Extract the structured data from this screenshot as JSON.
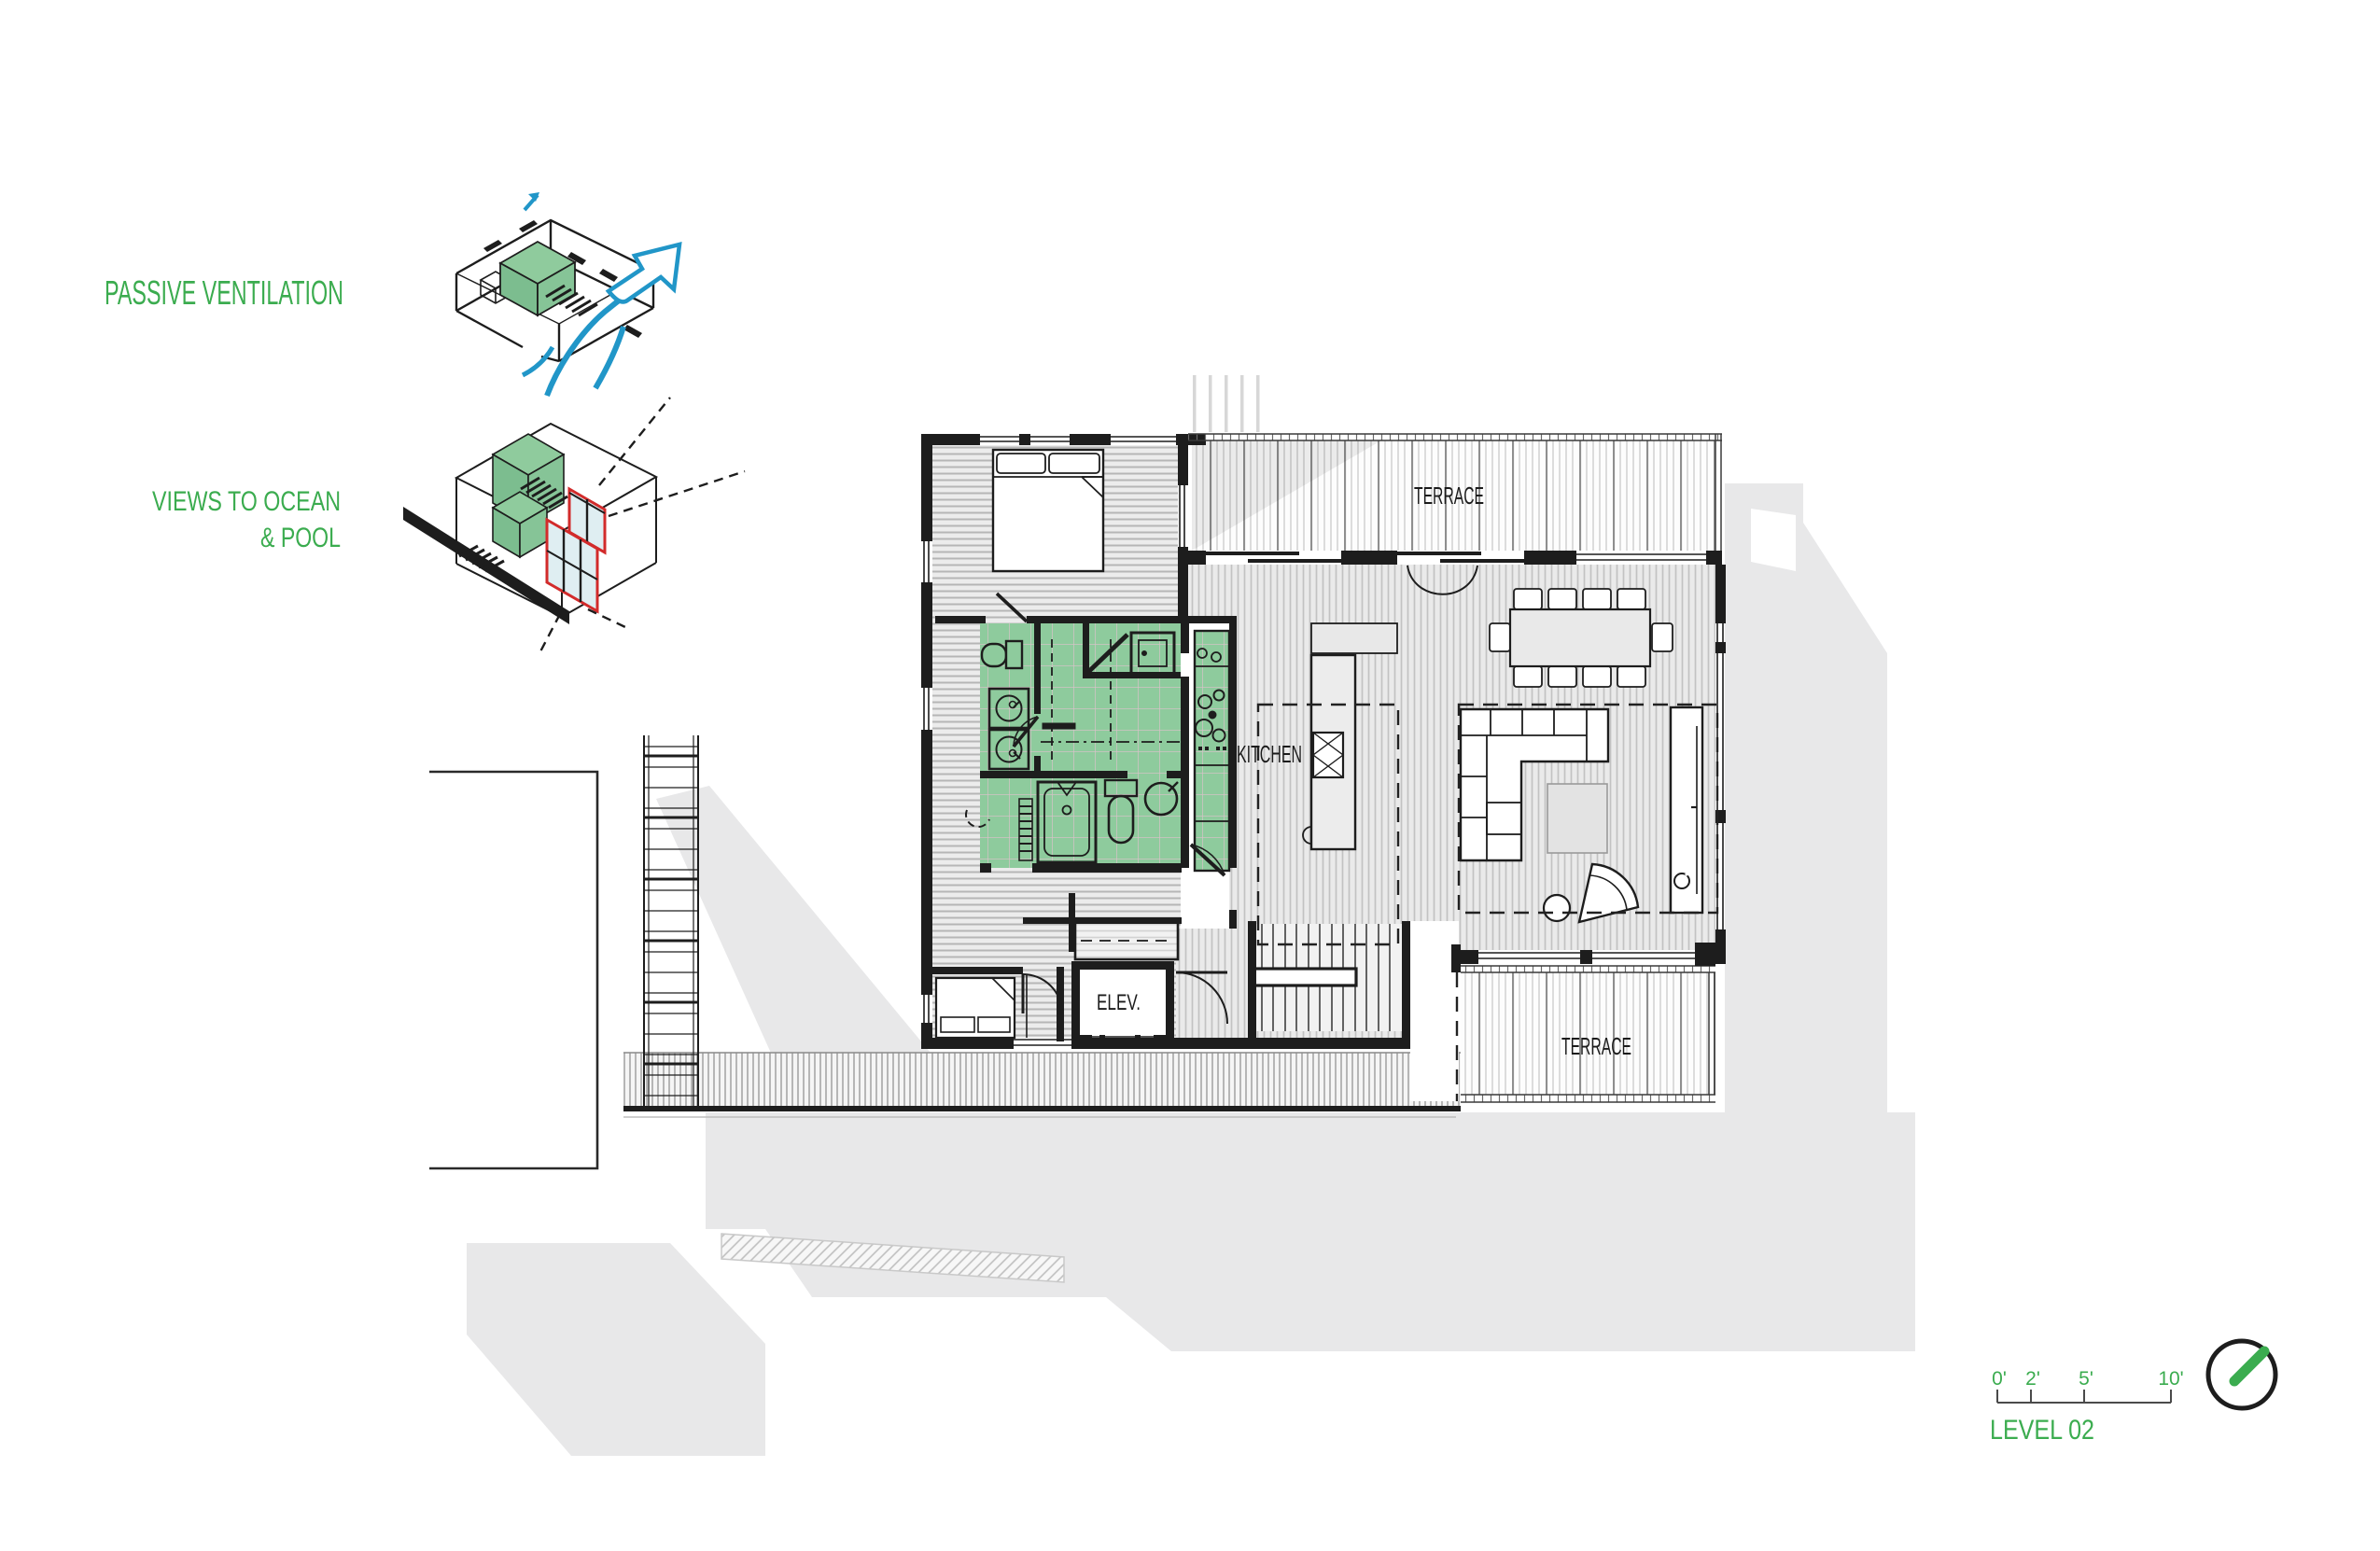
{
  "sheet": {
    "title": "LEVEL 02",
    "colors": {
      "accent_green": "#3BAC4F",
      "fill_green": "#8FCB9D",
      "arrow_blue": "#2196C8",
      "highlight_red": "#D22B2B",
      "wall_black": "#1d1d1d",
      "shadow_gray": "#e8e8e9"
    }
  },
  "annotations": {
    "passive_ventilation": "PASSIVE VENTILATION",
    "views_line1": "VIEWS TO OCEAN",
    "views_line2": "& POOL"
  },
  "plan": {
    "terrace_top_label": "TERRACE",
    "terrace_bottom_label": "TERRACE",
    "kitchen_label": "KITCHEN",
    "elevator_label": "ELEV."
  },
  "titleblock": {
    "level_label": "LEVEL 02",
    "scale_ticks": [
      "0'",
      "2'",
      "5'",
      "10'"
    ]
  }
}
